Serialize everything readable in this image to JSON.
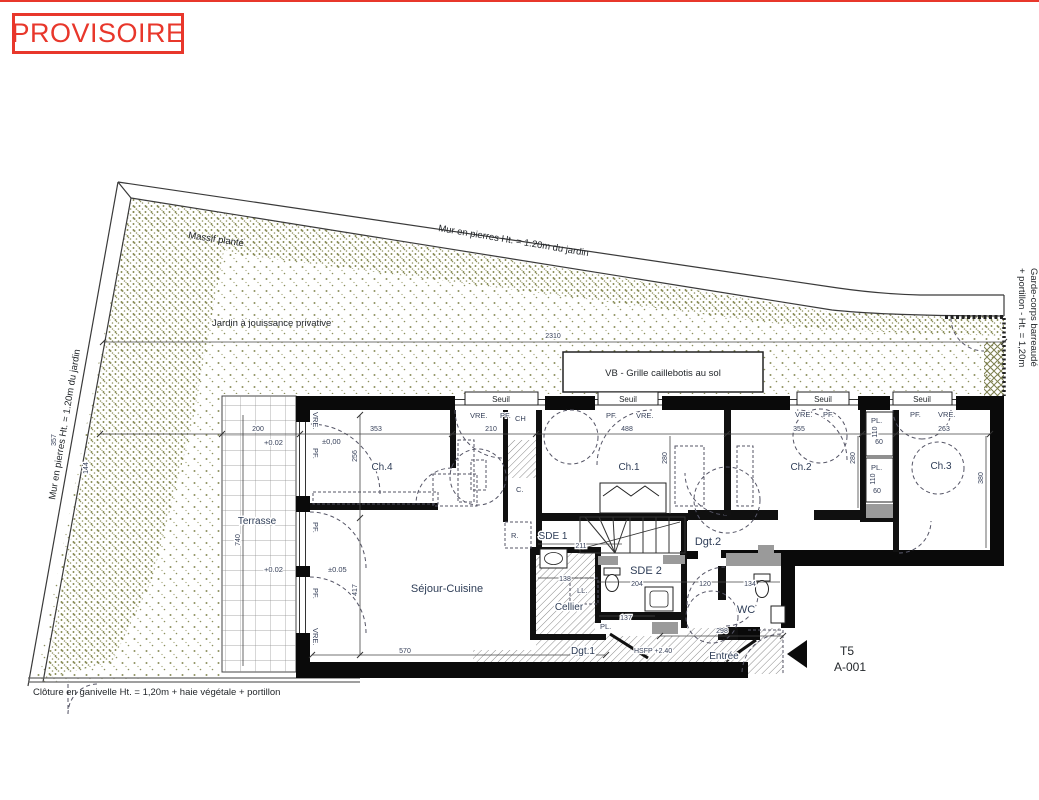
{
  "colors": {
    "accent_red": "#e8372b",
    "wall": "#0a0a0a",
    "garden_dot": "#8e9160",
    "label": "#2e3d57",
    "duct_gray": "#9a9a9a"
  },
  "stamp": {
    "label": "PROVISOIRE"
  },
  "site": {
    "wall_top_label": "Mur en pierres Ht. = 1.20m du jardin",
    "wall_left_label": "Mur en pierres Ht. = 1.20m du jardin",
    "massif": "Massif planté",
    "jardin": "Jardin à jouissance privative",
    "garde_corps_1": "Garde-corps barreaudé",
    "garde_corps_2": "+ portillon - Ht. = 1,20m",
    "cloture": "Clôture en ganivelle Ht. = 1,20m + haie végétale + portillon",
    "vb_note": "VB - Grille caillebotis au sol"
  },
  "plan": {
    "rooms": {
      "ch4": "Ch.4",
      "ch1": "Ch.1",
      "ch2": "Ch.2",
      "ch3": "Ch.3",
      "sejour": "Séjour-Cuisine",
      "terrasse": "Terrasse",
      "sde1": "SDE 1",
      "sde2": "SDE 2",
      "dgt2": "Dgt.2",
      "dgt1": "Dgt.1",
      "cellier": "Cellier",
      "wc": "WC",
      "entree": "Entrée"
    },
    "tags": {
      "seuil": "Seuil",
      "vre": "VRE.",
      "pf": "PF.",
      "pl": "PL.",
      "ll": "LL.",
      "ch": "CH",
      "c": "C.",
      "r": "R.",
      "hsfp": "HSFP +2.40"
    },
    "levels": {
      "l1": "±0,00",
      "l2": "+0.02",
      "l3": "+0.02",
      "l4": "±0.05"
    },
    "unit": {
      "type": "T5",
      "code": "A-001"
    }
  },
  "dims": {
    "d2310": "2310",
    "d353": "353",
    "d210": "210",
    "d488": "488",
    "d355": "355",
    "d263": "263",
    "d200": "200",
    "d357": "357",
    "d144": "144",
    "d256": "256",
    "d417": "417",
    "d740": "740",
    "d280a": "280",
    "d280b": "280",
    "d380": "380",
    "d110a": "110",
    "d60a": "60",
    "d110b": "110",
    "d60b": "60",
    "d211": "211",
    "d204": "204",
    "d120": "120",
    "d134": "134",
    "d138": "138",
    "d137": "137",
    "d570": "570",
    "d298": "298"
  }
}
